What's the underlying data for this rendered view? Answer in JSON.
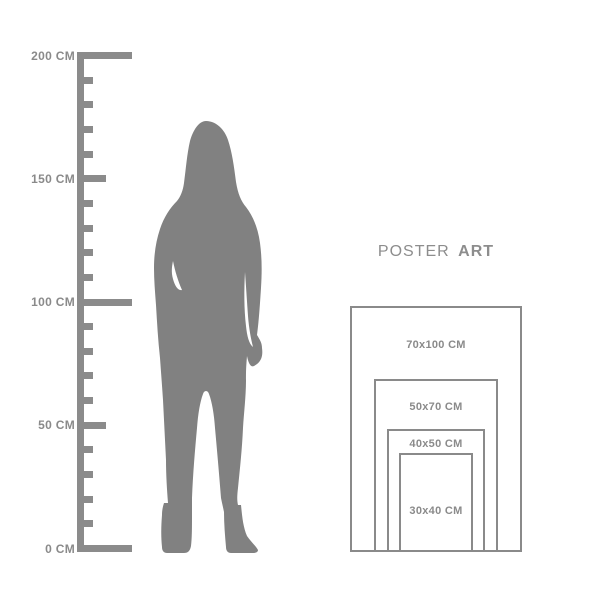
{
  "title": {
    "regular": "POSTER",
    "bold": "ART"
  },
  "ruler": {
    "unit": "CM",
    "min_cm": 0,
    "max_cm": 200,
    "major_step_cm": 50,
    "minor_step_cm": 10,
    "labels": [
      {
        "value": 200,
        "text": "200 CM"
      },
      {
        "value": 150,
        "text": "150 CM"
      },
      {
        "value": 100,
        "text": "100 CM"
      },
      {
        "value": 50,
        "text": "50 CM"
      },
      {
        "value": 0,
        "text": "0 CM"
      }
    ]
  },
  "silhouette": {
    "description": "standing-woman-silhouette"
  },
  "poster_sizes": [
    {
      "label": "70x100 CM",
      "width_cm": 70,
      "height_cm": 100
    },
    {
      "label": "50x70 CM",
      "width_cm": 50,
      "height_cm": 70
    },
    {
      "label": "40x50 CM",
      "width_cm": 40,
      "height_cm": 50
    },
    {
      "label": "30x40 CM",
      "width_cm": 30,
      "height_cm": 40
    }
  ],
  "colors": {
    "background": "#ffffff",
    "silhouette": "#818181",
    "ruler": "#8b8b8b",
    "label_text": "#8a8a8a",
    "poster_border": "#8a8a8a",
    "title_text": "#8d8d8d"
  }
}
